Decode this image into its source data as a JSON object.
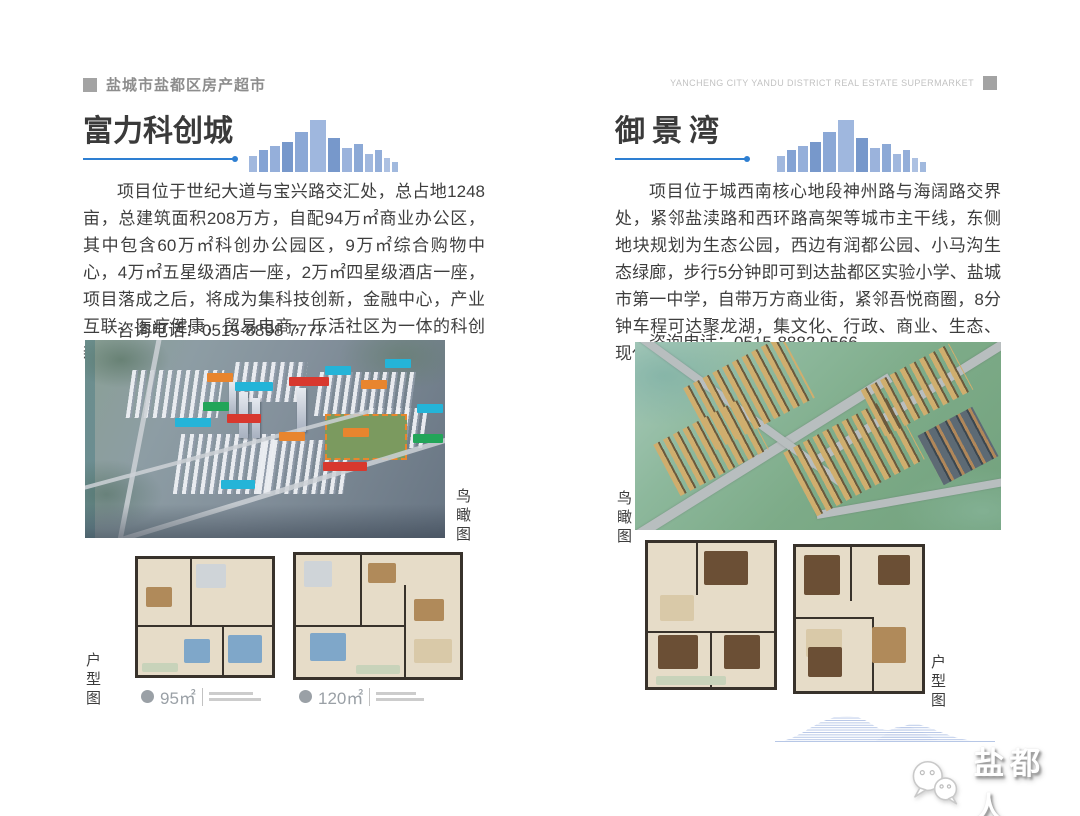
{
  "header": {
    "title_cn": "盐城市盐都区房产超市",
    "title_en": "YANCHENG CITY YANDU DISTRICT REAL ESTATE SUPERMARKET"
  },
  "projects": {
    "fuli": {
      "title": "富力科创城",
      "description": "项目位于世纪大道与宝兴路交汇处，总占地1248亩，总建筑面积208万方，自配94万㎡商业办公区，其中包含60万㎡科创办公园区，9万㎡综合购物中心，4万㎡五星级酒店一座，2万㎡四星级酒店一座，项目落成之后，将成为集科技创新，金融中心，产业互联，医疗健康，贸易电商，乐活社区为一体的科创新城。",
      "phone": "咨询电话：0515-8898 7777",
      "aerial_label": "鸟瞰图",
      "floorplan_label": "户型图",
      "floorplan_a_area": "95㎡",
      "floorplan_b_area": "120㎡"
    },
    "yujingwan": {
      "title": "御景湾",
      "description": "项目位于城西南核心地段神州路与海阔路交界处，紧邻盐渎路和西环路高架等城市主干线，东侧地块规划为生态公园，西边有润都公园、小马沟生态绿廊，步行5分钟即可到达盐都区实验小学、盐城市第一中学，自带万方商业街，紧邻吾悦商圈，8分钟车程可达聚龙湖，集文化、行政、商业、生态、现代化于一体的大都会生活。",
      "phone": "咨询电话：0515-8882 0566",
      "aerial_label": "鸟瞰图",
      "floorplan_label": "户型图"
    }
  },
  "footer": {
    "brand": "盐都人"
  },
  "colors": {
    "accent_blue": "#2e7fd2",
    "header_gray": "#a3a3a3",
    "chip_orange": "#e8852e",
    "chip_red": "#d8382e",
    "chip_teal": "#24b4d8",
    "chip_green": "#22a559"
  }
}
